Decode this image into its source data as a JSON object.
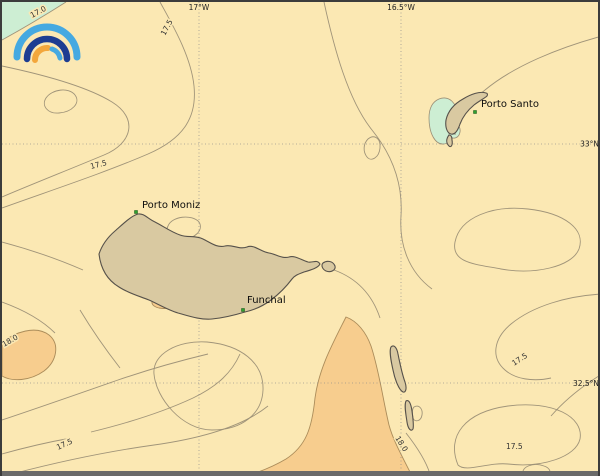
{
  "map": {
    "region": "Madeira archipelago",
    "contour_levels": [
      "17.0",
      "17.5",
      "18.0"
    ],
    "colors": {
      "sea": "#fbe8b3",
      "warm_band": "#f7cd8e",
      "cool_band": "#cdeed3",
      "land": "#d9c9a1",
      "contour_line": "#9b8f76",
      "marker_green": "#2fa02f",
      "logo_blue": "#45a9e1",
      "logo_navy": "#1d3d92",
      "logo_orange": "#f3a73c"
    },
    "grid_labels": {
      "top": [
        {
          "text": "17°W"
        },
        {
          "text": "16.5°W"
        }
      ],
      "right": [
        {
          "text": "33°N"
        },
        {
          "text": "32.5°N"
        }
      ]
    },
    "places": [
      {
        "name": "Porto Santo"
      },
      {
        "name": "Porto Moniz"
      },
      {
        "name": "Funchal"
      }
    ],
    "contour_labels": [
      {
        "text": "17.0"
      },
      {
        "text": "17.5"
      },
      {
        "text": "17.5"
      },
      {
        "text": "18.0"
      },
      {
        "text": "17.5"
      },
      {
        "text": "17.5"
      },
      {
        "text": "18.0"
      },
      {
        "text": "17.5"
      }
    ],
    "icons": {
      "logo": "rainbow-arcs"
    }
  }
}
